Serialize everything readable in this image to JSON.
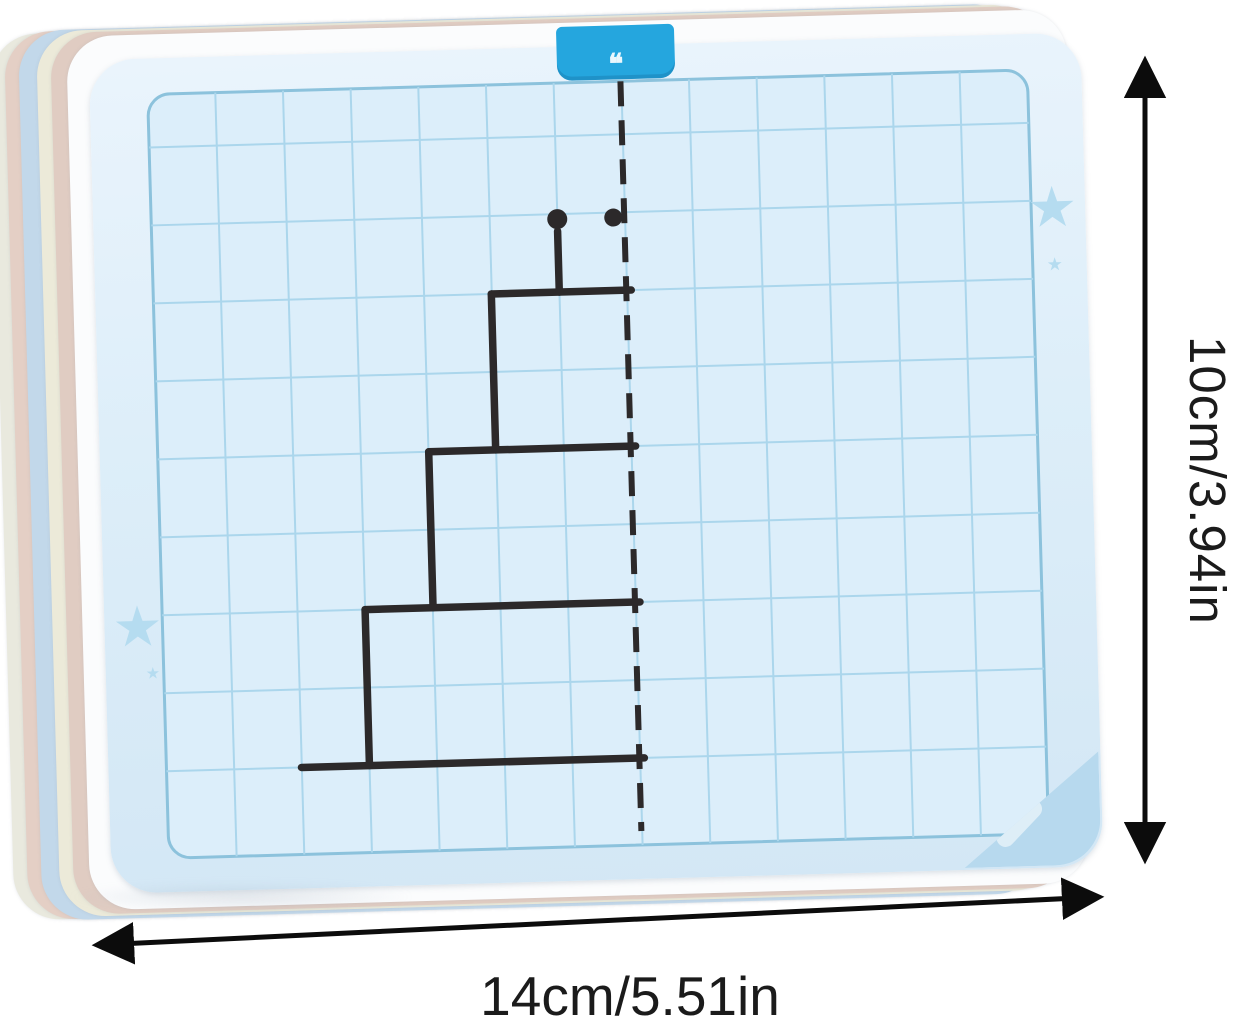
{
  "scene": {
    "background_color": "#ffffff",
    "description": "stack of dry-erase symmetry drawing flashcards with dimension arrows"
  },
  "card_stack": {
    "edge_colors": [
      "#e9e9de",
      "#e4cfc5",
      "#c2d8ea",
      "#ecead9",
      "#e0ccc2",
      "#fbfcfd"
    ]
  },
  "flashcard": {
    "surface_color": "#ddeef9",
    "tab": {
      "color": "#25a6de",
      "mark": "❝"
    },
    "decorations": {
      "star_glyph": "★",
      "star_color": "#b5dcf0",
      "pencil_corner_color": "#b7d9ee"
    },
    "grid": {
      "panel": {
        "x": 58,
        "y": 36,
        "w": 880,
        "h": 764,
        "radius": 22,
        "bg": "#dceefa",
        "border_color": "#8cc2dc",
        "border_width": 3
      },
      "cols": 13,
      "row_count": 9,
      "row_offset": 53,
      "row_spacing": 78,
      "line_color": "#abd6ec",
      "line_width": 2
    },
    "drawing": {
      "description": "left half of a three-tier cake with candle, to be mirrored across dashed line",
      "stroke_color": "#2c292a",
      "stroke_width": 7.5,
      "mirror_line": {
        "x": 531,
        "y1": 36,
        "y2": 786,
        "width": 6,
        "dash": "25 14"
      },
      "segments": [
        {
          "x1": 193,
          "y1": 713,
          "x2": 536,
          "y2": 713
        },
        {
          "x1": 261,
          "y1": 713,
          "x2": 261,
          "y2": 557
        },
        {
          "x1": 261,
          "y1": 557,
          "x2": 536,
          "y2": 557
        },
        {
          "x1": 329,
          "y1": 557,
          "x2": 329,
          "y2": 401
        },
        {
          "x1": 329,
          "y1": 401,
          "x2": 536,
          "y2": 401
        },
        {
          "x1": 396,
          "y1": 401,
          "x2": 396,
          "y2": 245
        },
        {
          "x1": 396,
          "y1": 245,
          "x2": 536,
          "y2": 245
        },
        {
          "x1": 464,
          "y1": 245,
          "x2": 464,
          "y2": 184
        }
      ],
      "dots": [
        {
          "cx": 464,
          "cy": 172,
          "r": 10
        },
        {
          "cx": 520,
          "cy": 172,
          "r": 9
        }
      ]
    }
  },
  "dimensions": {
    "height_label": "10cm/3.94in",
    "width_label": "14cm/5.51in",
    "arrow_color": "#0c0c0c"
  }
}
